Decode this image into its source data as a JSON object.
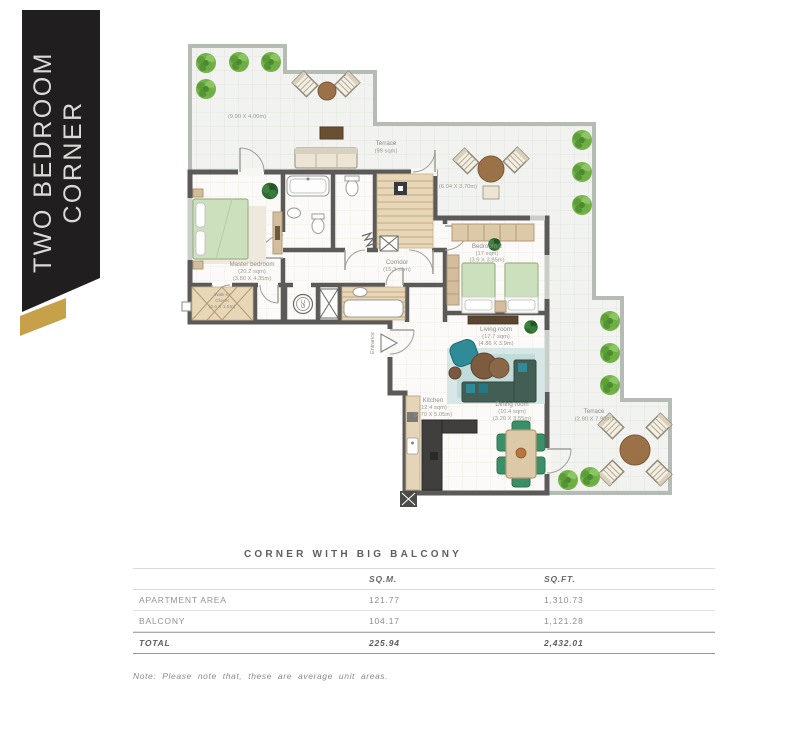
{
  "banner": {
    "line1": "TWO BEDROOM",
    "line2": "CORNER"
  },
  "floorplan": {
    "terrace_top": {
      "dim": "(9.90 X 4.00m)",
      "name": "Terrace",
      "area": "(99 sqm)",
      "dim2": "(6.04 X 3.70m)"
    },
    "master_bedroom": {
      "name": "Master bedroom",
      "area": "(20.2 sqm)",
      "dim": "(3.80 X 4.35m)"
    },
    "walkin_closet": {
      "name": "Walk-in",
      "name2": "Closet",
      "dim": "(2.6 X 1.5m)"
    },
    "corridor": {
      "name": "Corridor",
      "area": "(15.3 sqm)"
    },
    "bedroom2": {
      "name": "Bedroom 2",
      "area": "(17 sqm)",
      "dim": "(3.9 X 3.85m)"
    },
    "living_room": {
      "name": "Living room",
      "area": "(17.7 sqm)",
      "dim": "(4.86 X 3.9m)"
    },
    "dining_room": {
      "name": "Dining room",
      "area": "(10.4 sqm)",
      "dim": "(3.20 X 3.55m)"
    },
    "kitchen": {
      "name": "Kitchen",
      "area": "(12.4 sqm)",
      "dim": "(2.70 X 5.05m)"
    },
    "terrace_bottom": {
      "name": "Terrace",
      "dim": "(2.90 X 7.90m)"
    },
    "entrance_label": "Entrance",
    "gc_label": "GC"
  },
  "table": {
    "title": "CORNER WITH BIG BALCONY",
    "columns": {
      "sqm": "SQ.M.",
      "sqft": "SQ.FT."
    },
    "rows": [
      {
        "label": "APARTMENT AREA",
        "sqm": "121.77",
        "sqft": "1,310.73"
      },
      {
        "label": "BALCONY",
        "sqm": "104.17",
        "sqft": "1,121.28"
      }
    ],
    "total": {
      "label": "TOTAL",
      "sqm": "225.94",
      "sqft": "2,432.01"
    },
    "note": "Note: Please note that, these are average unit areas."
  },
  "colors": {
    "accent_gold": "#c7a04a",
    "banner_black": "#201e1f",
    "wall_dark": "#5c5a58",
    "wall_light": "#b5bcb5"
  }
}
